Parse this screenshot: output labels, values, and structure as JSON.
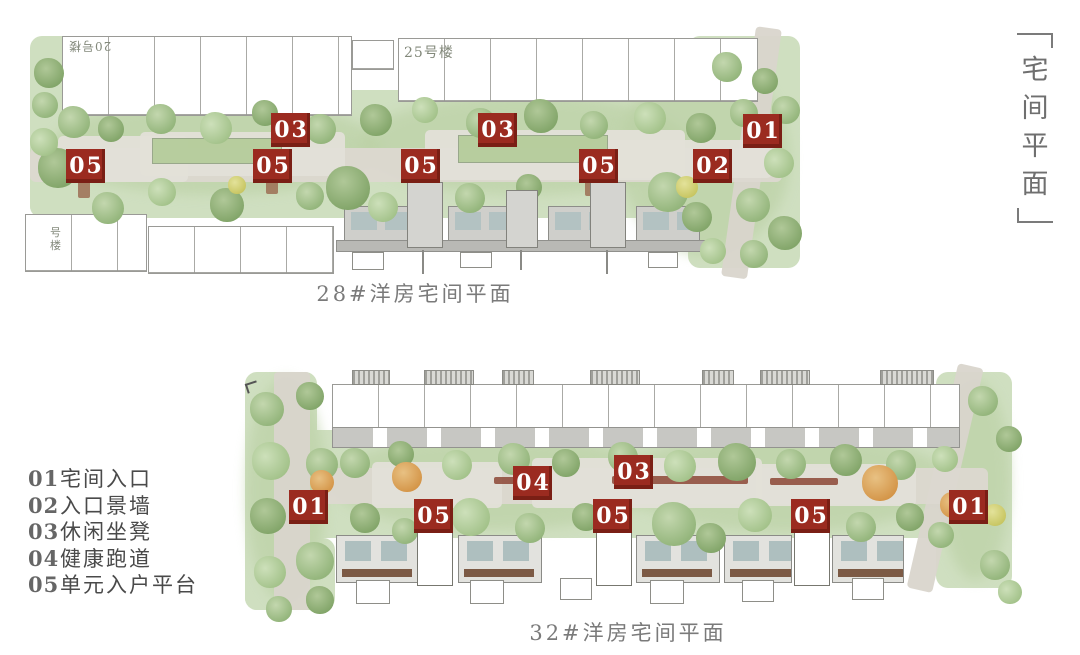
{
  "side_title": {
    "chars": [
      "宅",
      "间",
      "平",
      "面"
    ]
  },
  "legend": {
    "items": [
      {
        "num": "01",
        "label": "宅间入口"
      },
      {
        "num": "02",
        "label": "入口景墙"
      },
      {
        "num": "03",
        "label": "休闲坐凳"
      },
      {
        "num": "04",
        "label": "健康跑道"
      },
      {
        "num": "05",
        "label": "单元入户平台"
      }
    ]
  },
  "plans": [
    {
      "caption": "28#洋房宅间平面",
      "building_labels": {
        "top_left": "20号楼",
        "top_right": "25号楼",
        "bottom_left": "号楼"
      },
      "markers": [
        {
          "label": "05"
        },
        {
          "label": "03"
        },
        {
          "label": "05"
        },
        {
          "label": "05"
        },
        {
          "label": "03"
        },
        {
          "label": "05"
        },
        {
          "label": "02"
        },
        {
          "label": "01"
        }
      ]
    },
    {
      "caption": "32#洋房宅间平面",
      "markers": [
        {
          "label": "01"
        },
        {
          "label": "05"
        },
        {
          "label": "04"
        },
        {
          "label": "03"
        },
        {
          "label": "05"
        },
        {
          "label": "05"
        },
        {
          "label": "01"
        }
      ]
    }
  ],
  "colors": {
    "marker_red": "#9b2b20",
    "text_gray": "#6e6e6e",
    "landscape_green": "#cfdfc0"
  }
}
